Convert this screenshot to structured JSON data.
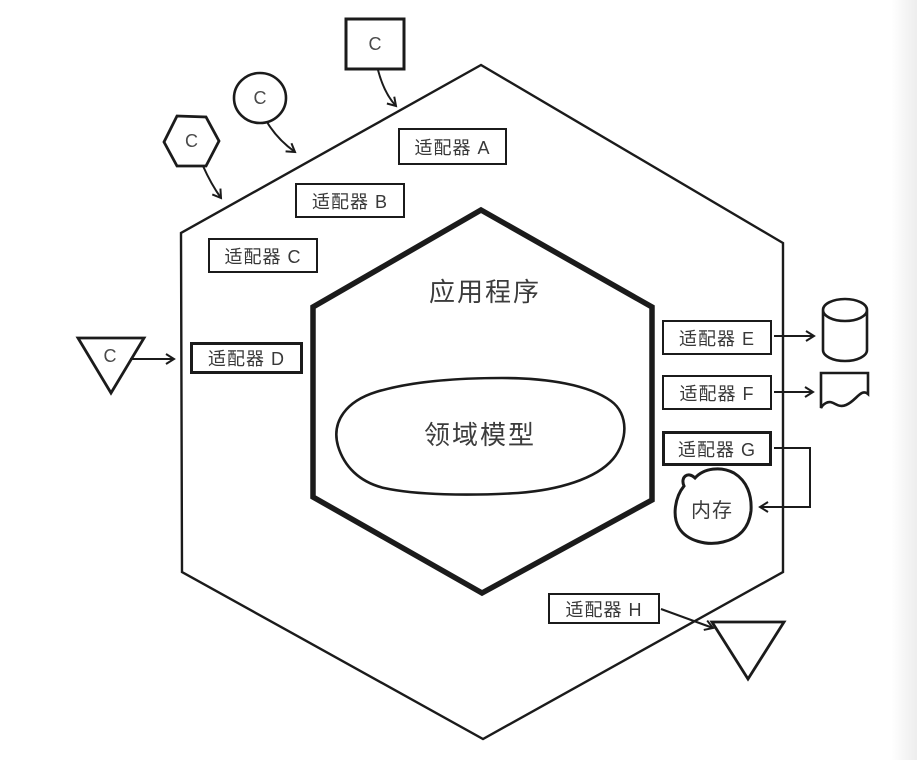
{
  "diagram": {
    "app_label": "应用程序",
    "domain_label": "领域模型",
    "memory_label": "内存",
    "adapters": {
      "a": "适配器 A",
      "b": "适配器 B",
      "c": "适配器 C",
      "d": "适配器 D",
      "e": "适配器 E",
      "f": "适配器 F",
      "g": "适配器 G",
      "h": "适配器 H"
    },
    "clients": {
      "square": "C",
      "ellipse": "C",
      "hexagon": "C",
      "triangle": "C"
    },
    "colors": {
      "line": "#1b1b1b",
      "text": "#3c3c3c",
      "background": "#ffffff"
    }
  }
}
